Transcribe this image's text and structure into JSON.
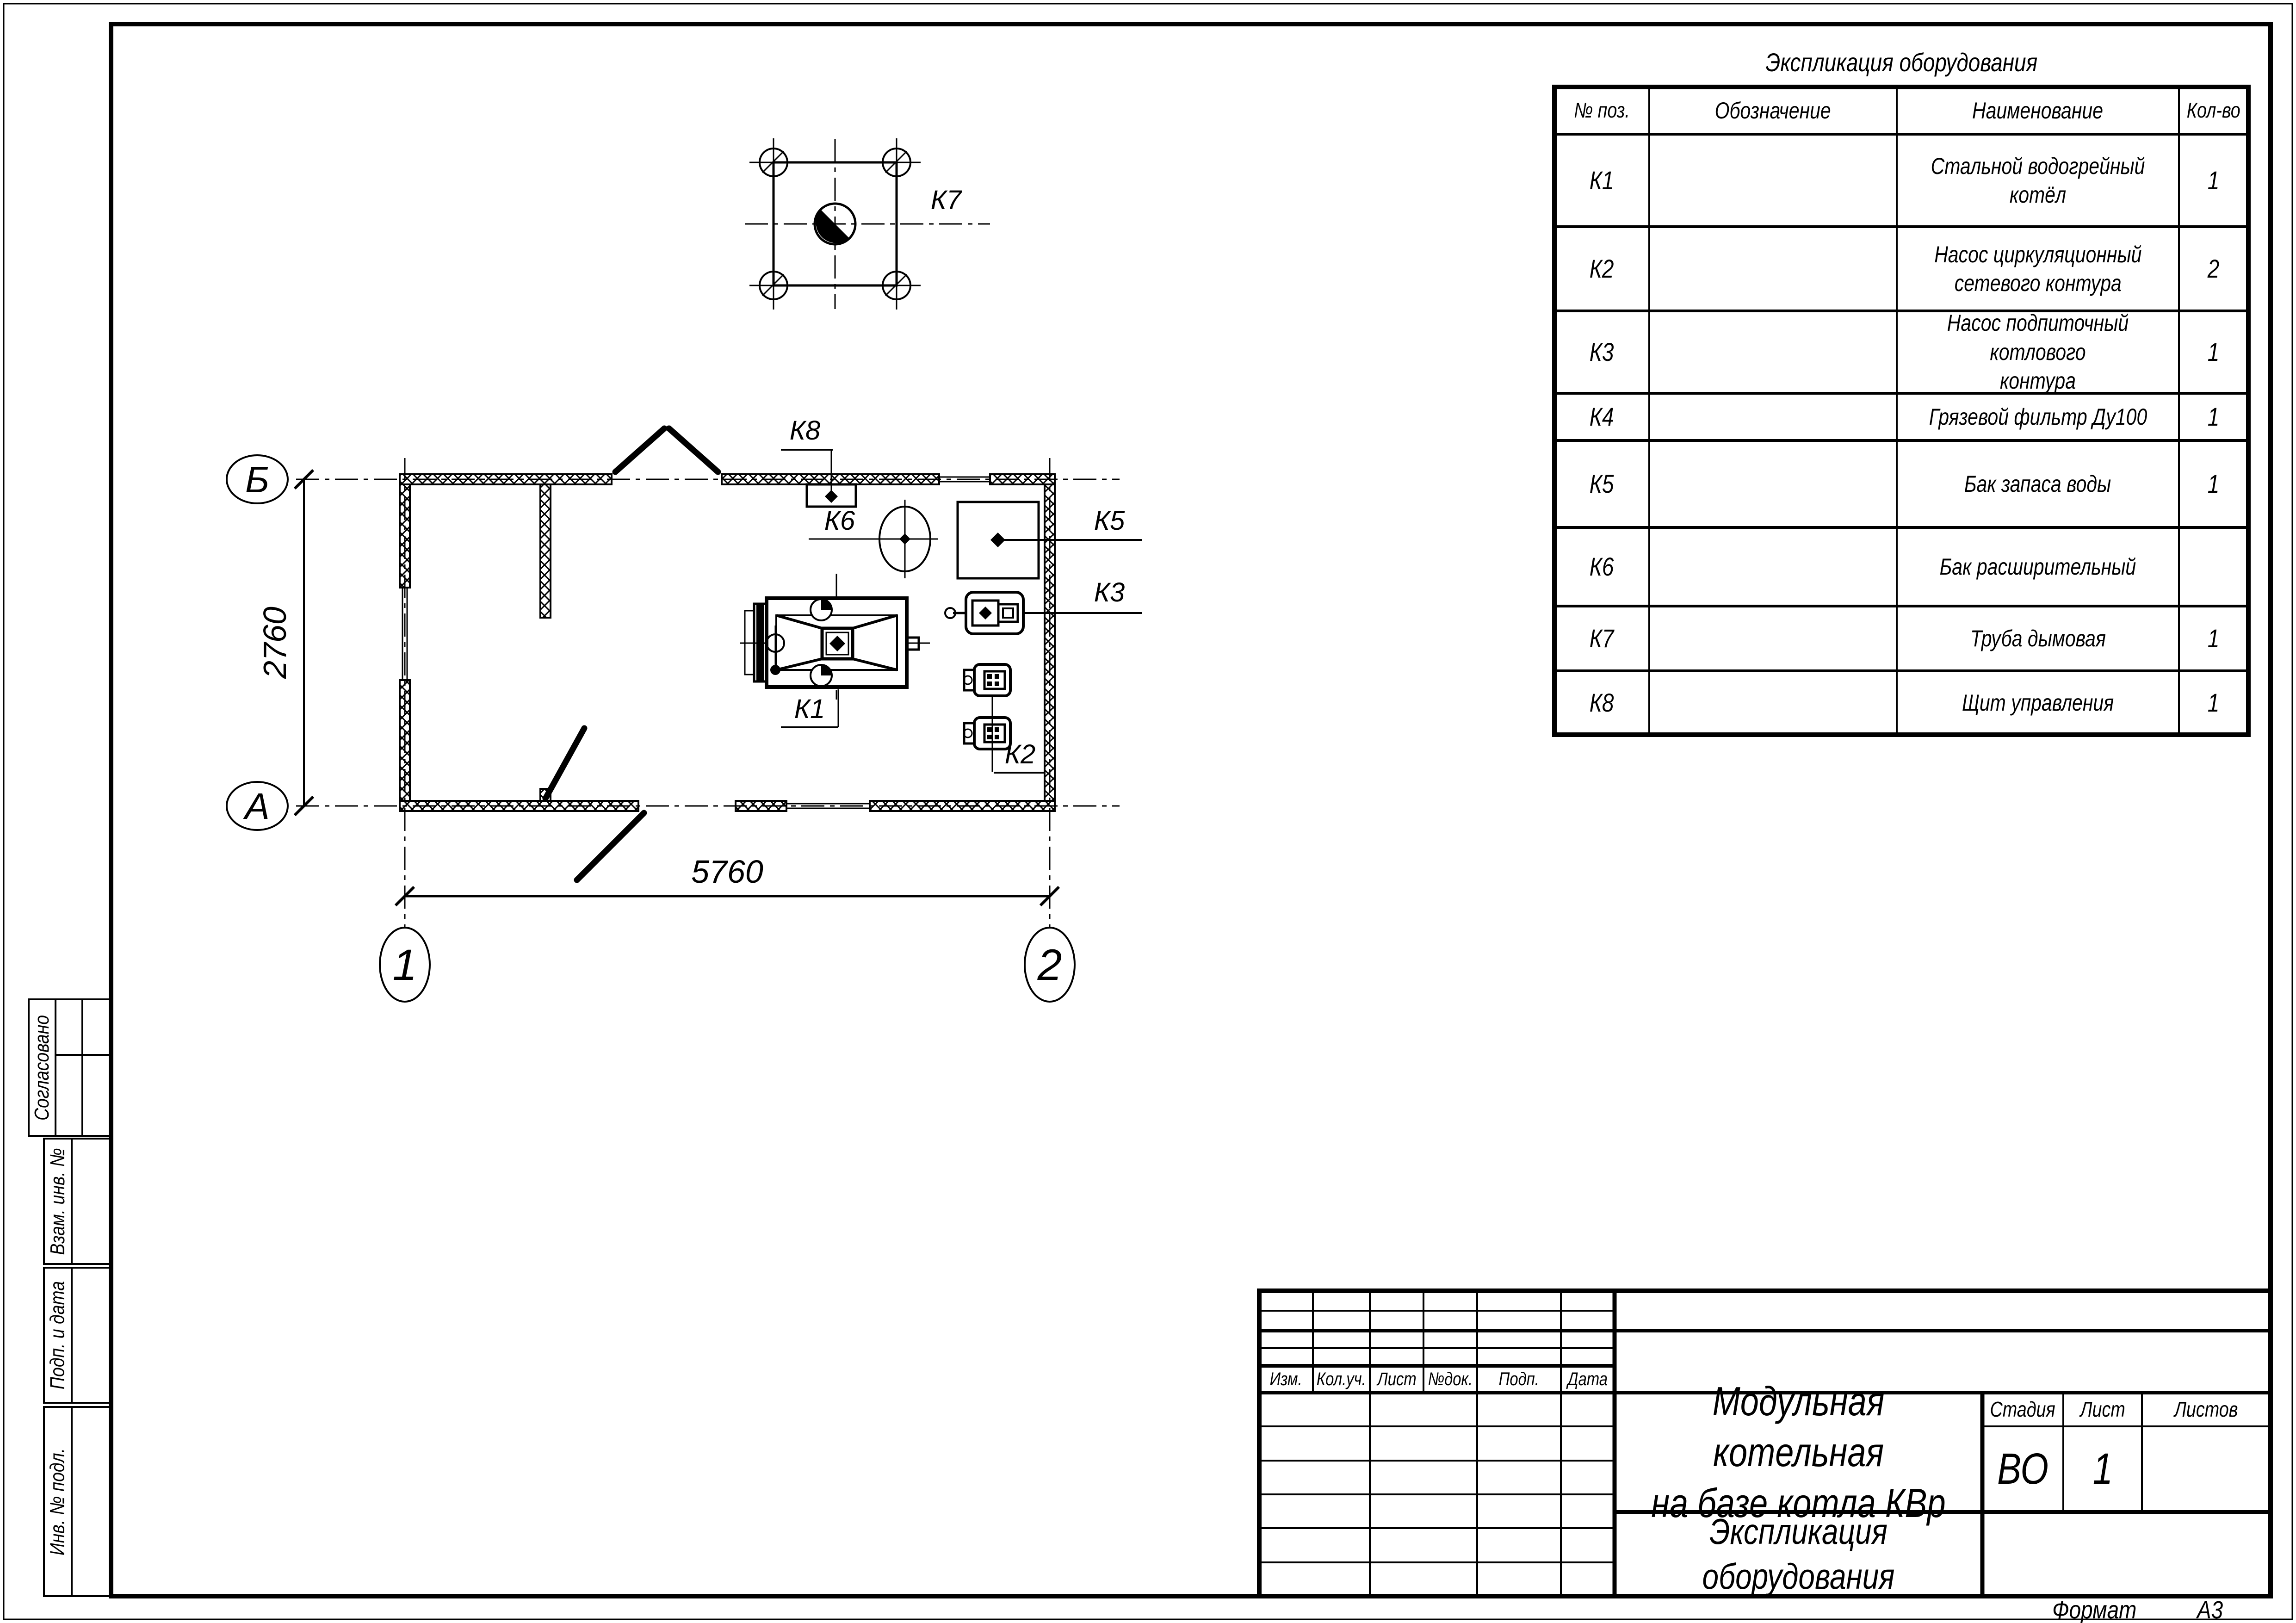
{
  "sheet": {
    "format_label": "Формат",
    "format_value": "А3"
  },
  "equipment_table": {
    "title": "Экспликация оборудования",
    "headers": {
      "pos": "№ поз.",
      "designation": "Обозначение",
      "name": "Наименование",
      "qty": "Кол-во"
    },
    "rows": [
      {
        "pos": "К1",
        "designation": "",
        "name": "Стальной водогрейный котёл",
        "qty": "1"
      },
      {
        "pos": "К2",
        "designation": "",
        "name": "Насос циркуляционный\nсетевого контура",
        "qty": "2"
      },
      {
        "pos": "К3",
        "designation": "",
        "name": "Насос подпиточный котлового\nконтура",
        "qty": "1"
      },
      {
        "pos": "К4",
        "designation": "",
        "name": "Грязевой фильтр Ду100",
        "qty": "1"
      },
      {
        "pos": "К5",
        "designation": "",
        "name": "Бак запаса воды",
        "qty": "1"
      },
      {
        "pos": "К6",
        "designation": "",
        "name": "Бак расширительный",
        "qty": ""
      },
      {
        "pos": "К7",
        "designation": "",
        "name": "Труба дымовая",
        "qty": "1"
      },
      {
        "pos": "К8",
        "designation": "",
        "name": "Щит управления",
        "qty": "1"
      }
    ]
  },
  "plan": {
    "axis_b": "Б",
    "axis_a": "А",
    "axis_1": "1",
    "axis_2": "2",
    "dim_vertical": "2760",
    "dim_horizontal": "5760",
    "tags": {
      "k1": "К1",
      "k2": "К2",
      "k3": "К3",
      "k5": "К5",
      "k6": "К6",
      "k7": "К7",
      "k8": "К8"
    }
  },
  "title_block": {
    "revision_headers": [
      "Изм.",
      "Кол.уч.",
      "Лист",
      "№док.",
      "Подп.",
      "Дата"
    ],
    "project_title": "Модульная котельная\nна базе котла КВр",
    "doc_title": "Экспликация оборудования",
    "stage_label": "Стадия",
    "stage_value": "ВО",
    "sheet_label": "Лист",
    "sheet_value": "1",
    "sheets_label": "Листов",
    "sheets_value": ""
  },
  "side_stamps": [
    "Согласовано",
    "Взам. инв. №",
    "Подп. и дата",
    "Инв. № подл."
  ]
}
